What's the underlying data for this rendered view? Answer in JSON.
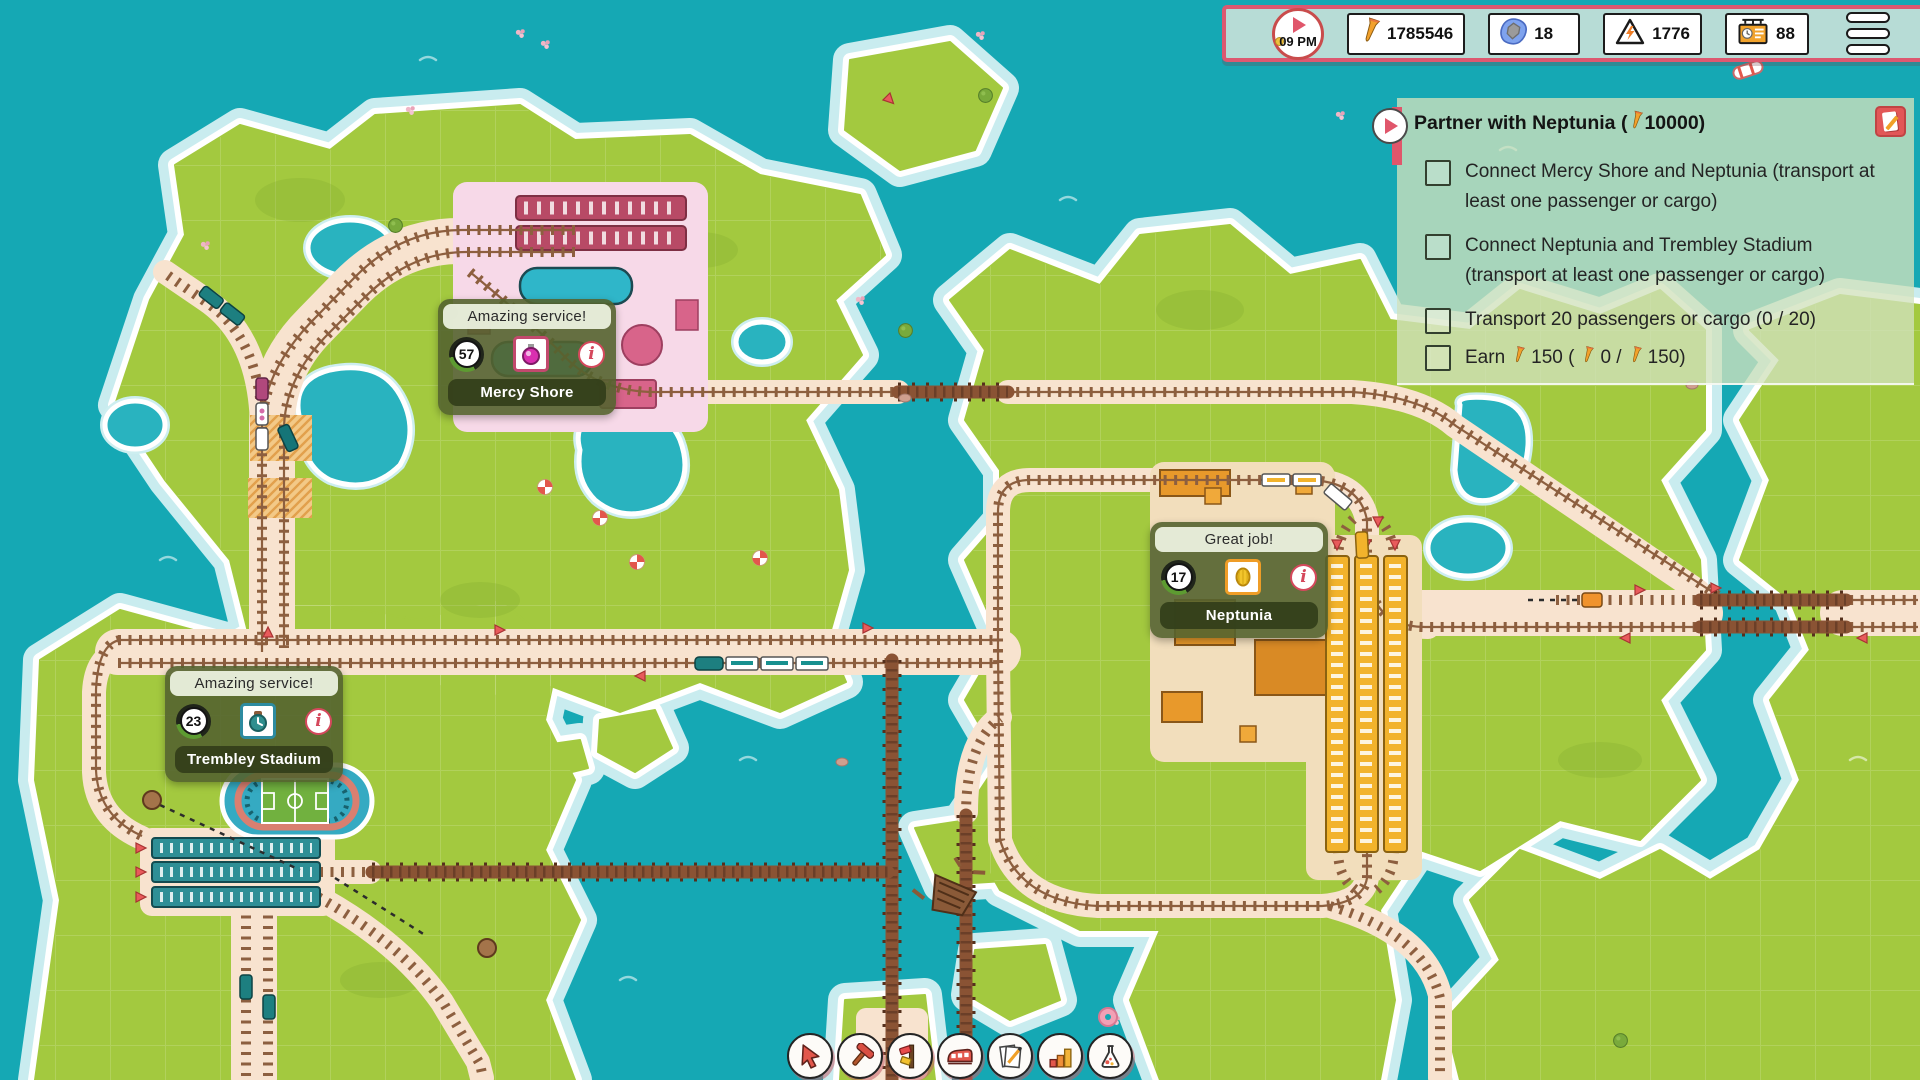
{
  "palette": {
    "water": "#15a8b4",
    "land": "#a3c93f",
    "shore_halo": "#c9ecef",
    "corridor": "#f8e3cf",
    "track_brown": "#8d5f3f",
    "hud_bg": "#b7dcd6",
    "hud_border": "#dd5870",
    "quest_bg": "#d1e2bc",
    "station_panel": "#546331",
    "accent_red": "#e2574c",
    "nail_orange": "#f2a12c"
  },
  "hud": {
    "time": "09 PM",
    "resources": [
      {
        "id": "money",
        "icon": "nail-icon",
        "value": "1785546"
      },
      {
        "id": "stone",
        "icon": "stone-icon",
        "value": "18"
      },
      {
        "id": "power",
        "icon": "hazard-icon",
        "value": "1776"
      },
      {
        "id": "schedule",
        "icon": "schedule-icon",
        "value": "88"
      }
    ]
  },
  "quest": {
    "title_prefix": "Partner with Neptunia (",
    "title_reward": "10000)",
    "objectives": [
      {
        "text": "Connect Mercy Shore and Neptunia (transport at least one passenger or cargo)",
        "checked": false
      },
      {
        "text": "Connect Neptunia and Trembley Stadium (transport at least one passenger or cargo)",
        "checked": false
      },
      {
        "text": "Transport 20 passengers or cargo (0 / 20)",
        "checked": false
      }
    ],
    "earn": {
      "prefix": "Earn",
      "target": "150 (",
      "current": "0 /",
      "total": "150)",
      "checked": false
    }
  },
  "stations": [
    {
      "banner": "Amazing service!",
      "count": "57",
      "name": "Mercy Shore",
      "good": "cosmetics"
    },
    {
      "banner": "Great job!",
      "count": "17",
      "name": "Neptunia",
      "good": "melon"
    },
    {
      "banner": "Amazing service!",
      "count": "23",
      "name": "Trembley Stadium",
      "good": "clock"
    }
  ],
  "toolbar": {
    "buttons": [
      {
        "id": "select",
        "icon": "cursor-icon"
      },
      {
        "id": "build",
        "icon": "hammer-icon"
      },
      {
        "id": "signals",
        "icon": "signal-icon"
      },
      {
        "id": "trains",
        "icon": "train-icon"
      },
      {
        "id": "contracts",
        "icon": "contract-icon"
      },
      {
        "id": "statistics",
        "icon": "chart-icon"
      },
      {
        "id": "research",
        "icon": "flask-icon"
      }
    ]
  }
}
